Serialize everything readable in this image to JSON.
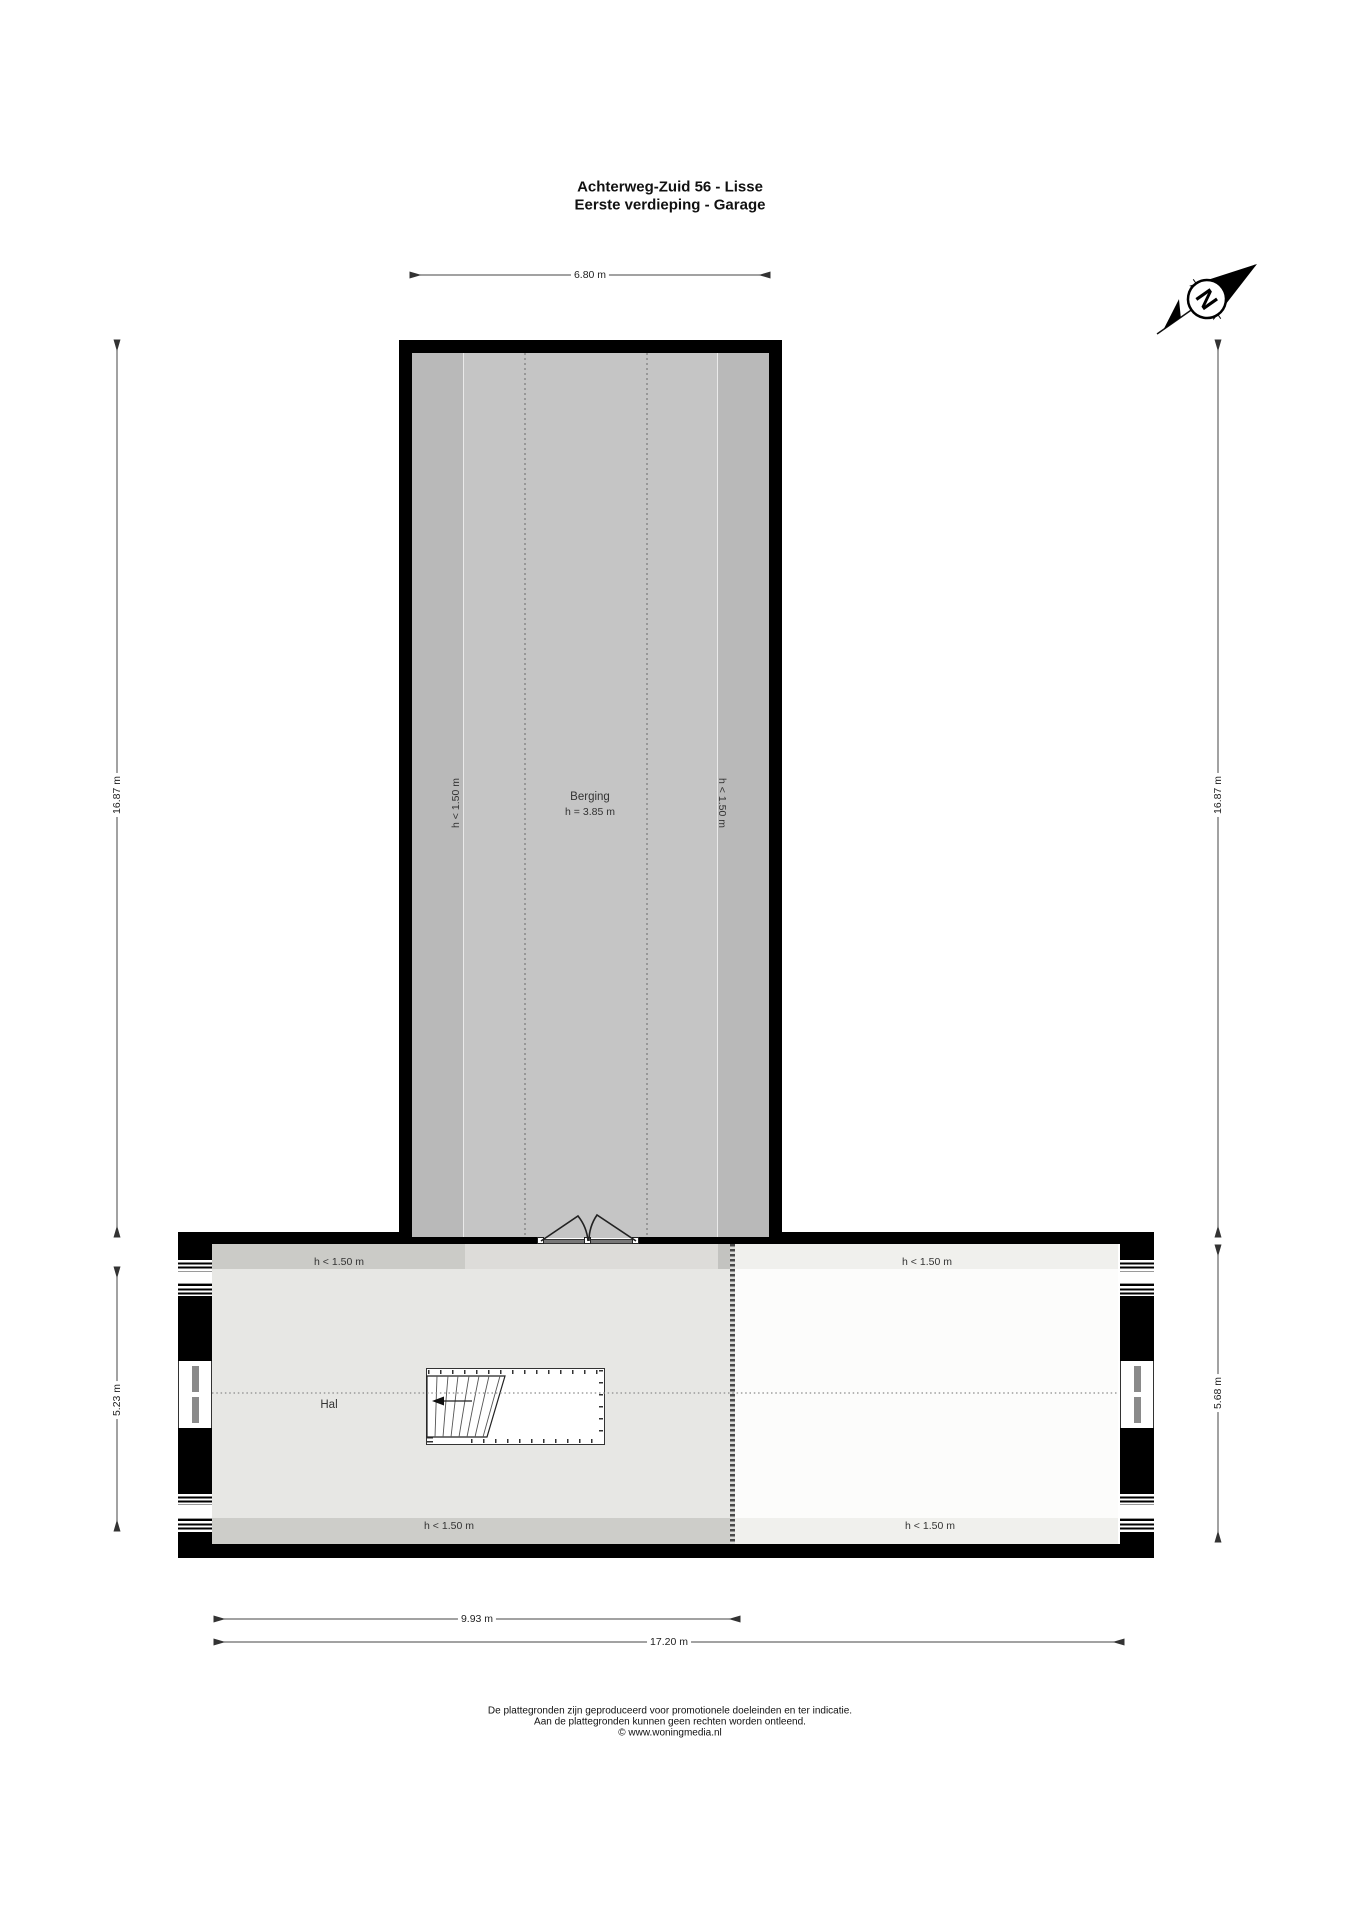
{
  "title": {
    "line1": "Achterweg-Zuid 56 - Lisse",
    "line2": "Eerste verdieping - Garage"
  },
  "compass": {
    "north_label": "N"
  },
  "dimensions": {
    "berging_width": "6.80 m",
    "left_total_height": "16.87 m",
    "right_total_height": "16.87 m",
    "hal_height": "5.23 m",
    "attic_height": "5.68 m",
    "hal_width": "9.93 m",
    "total_width": "17.20 m"
  },
  "rooms": {
    "berging": {
      "name": "Berging",
      "ceiling_height": "h = 3.85 m",
      "left_low_ceiling": "h < 1.50 m",
      "right_low_ceiling": "h < 1.50 m"
    },
    "hal": {
      "name": "Hal",
      "top_low_ceiling": "h < 1.50 m",
      "bottom_low_ceiling": "h < 1.50 m"
    },
    "attic": {
      "top_low_ceiling": "h < 1.50 m",
      "bottom_low_ceiling": "h < 1.50 m"
    }
  },
  "footer": {
    "line1": "De plattegronden zijn geproduceerd voor promotionele doeleinden en ter indicatie.",
    "line2": "Aan de plattegronden kunnen geen rechten worden ontleend.",
    "line3": "© www.woningmedia.nl"
  },
  "colors": {
    "wall": "#000000",
    "berging_floor": "#c5c5c5",
    "berging_low": "#b9b9b9",
    "hal_floor": "#e7e7e4",
    "hal_low_strip": "#cbcbc7",
    "attic_floor": "#fcfcfb",
    "attic_low_strip": "#f0f0ed"
  }
}
